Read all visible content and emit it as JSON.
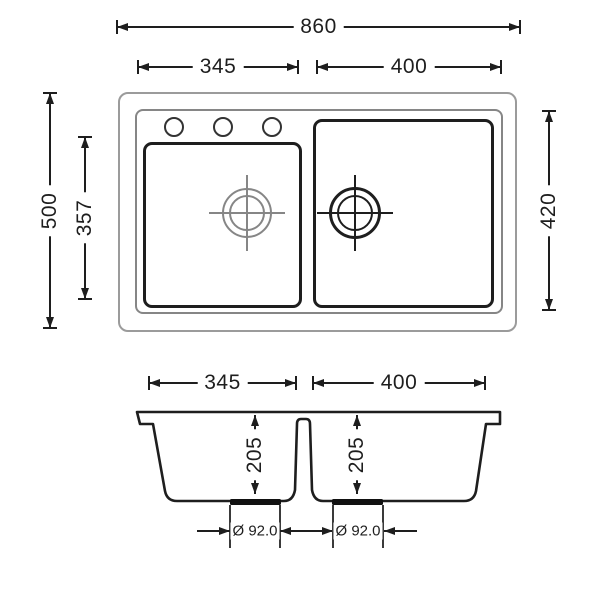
{
  "dims": {
    "overall_width": "860",
    "top_left_bowl_width": "345",
    "top_right_bowl_width": "400",
    "overall_depth": "500",
    "left_bowl_inner_depth": "357",
    "right_bowl_depth": "420",
    "section_left_bowl_width": "345",
    "section_right_bowl_width": "400",
    "section_left_bowl_depth": "205",
    "section_right_bowl_depth": "205",
    "left_drain_diameter": "Ø 92.0",
    "right_drain_diameter": "Ø 92.0"
  },
  "colors": {
    "ink": "#1e1e1e",
    "secondary_gray": "#9b9b9b",
    "background": "#ffffff"
  }
}
